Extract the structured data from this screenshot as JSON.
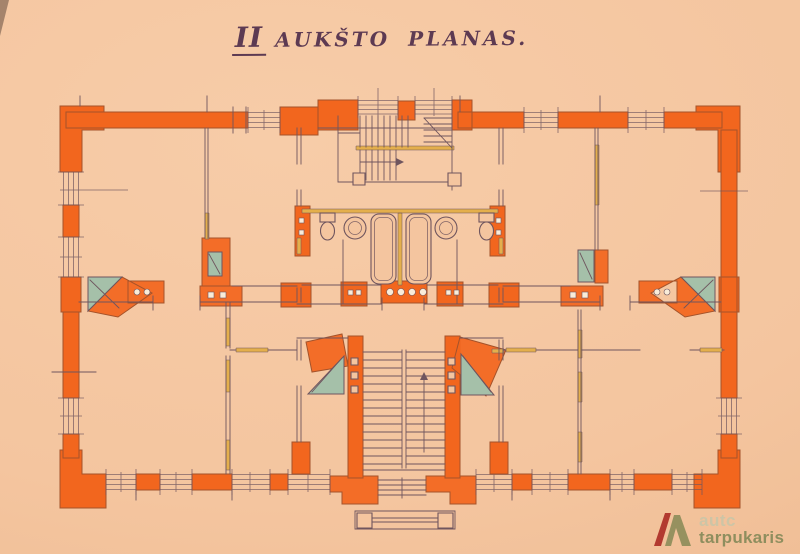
{
  "title": {
    "full": "II AUKŠTO PLANAS.",
    "prefix": "II",
    "rest": "AUKŠTO PLANAS."
  },
  "watermark": {
    "word1": "autc",
    "word2": "tarpukaris"
  },
  "drawing": {
    "kind": "hand-drawn second floor architectural plan, ink and watercolor on peach paper",
    "features": {
      "walls": "orange watercolor masonry walls",
      "partitions": "yellow light partitions",
      "stoves": "teal corner tile stoves",
      "stairs": "two stair flights, top and bottom center",
      "bathrooms": "two bathtubs, basins and toilets in center band",
      "porch": "columned entrance porch at bottom center"
    }
  },
  "colors": {
    "paper": "#f4c59f",
    "wall": "#f2661e",
    "wall_edge": "#a4532b",
    "ink": "#6f555e",
    "yellow": "#e4af4c",
    "teal": "#a5c0a9",
    "title_ink": "#5d3a52",
    "flue_dot": "#f9ecd9",
    "wm_light": "#cdc5a6",
    "wm_dark": "#8e8e5e",
    "wm_red": "#b23a30",
    "wm_olive": "#96915f"
  }
}
